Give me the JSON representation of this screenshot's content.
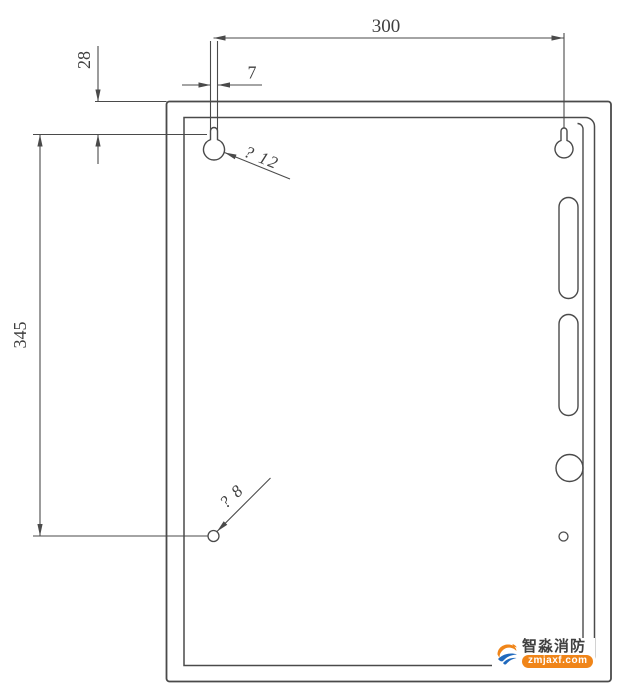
{
  "page": {
    "background": "#ffffff"
  },
  "drawing": {
    "type": "cabinet-mounting-dimension-drawing",
    "line_color": "#4a4a4a",
    "labels": {
      "dim_width": "300",
      "dim_slot_width": "7",
      "dim_top_offset": "28",
      "dim_height": "345",
      "keyhole_note": "? 12",
      "hole_note": "? 8"
    }
  },
  "watermark": {
    "brand": "智淼消防",
    "site": "zmjaxf.com",
    "colors": {
      "orange": "#f08519",
      "blue": "#2069bd",
      "text": "#404040"
    }
  }
}
